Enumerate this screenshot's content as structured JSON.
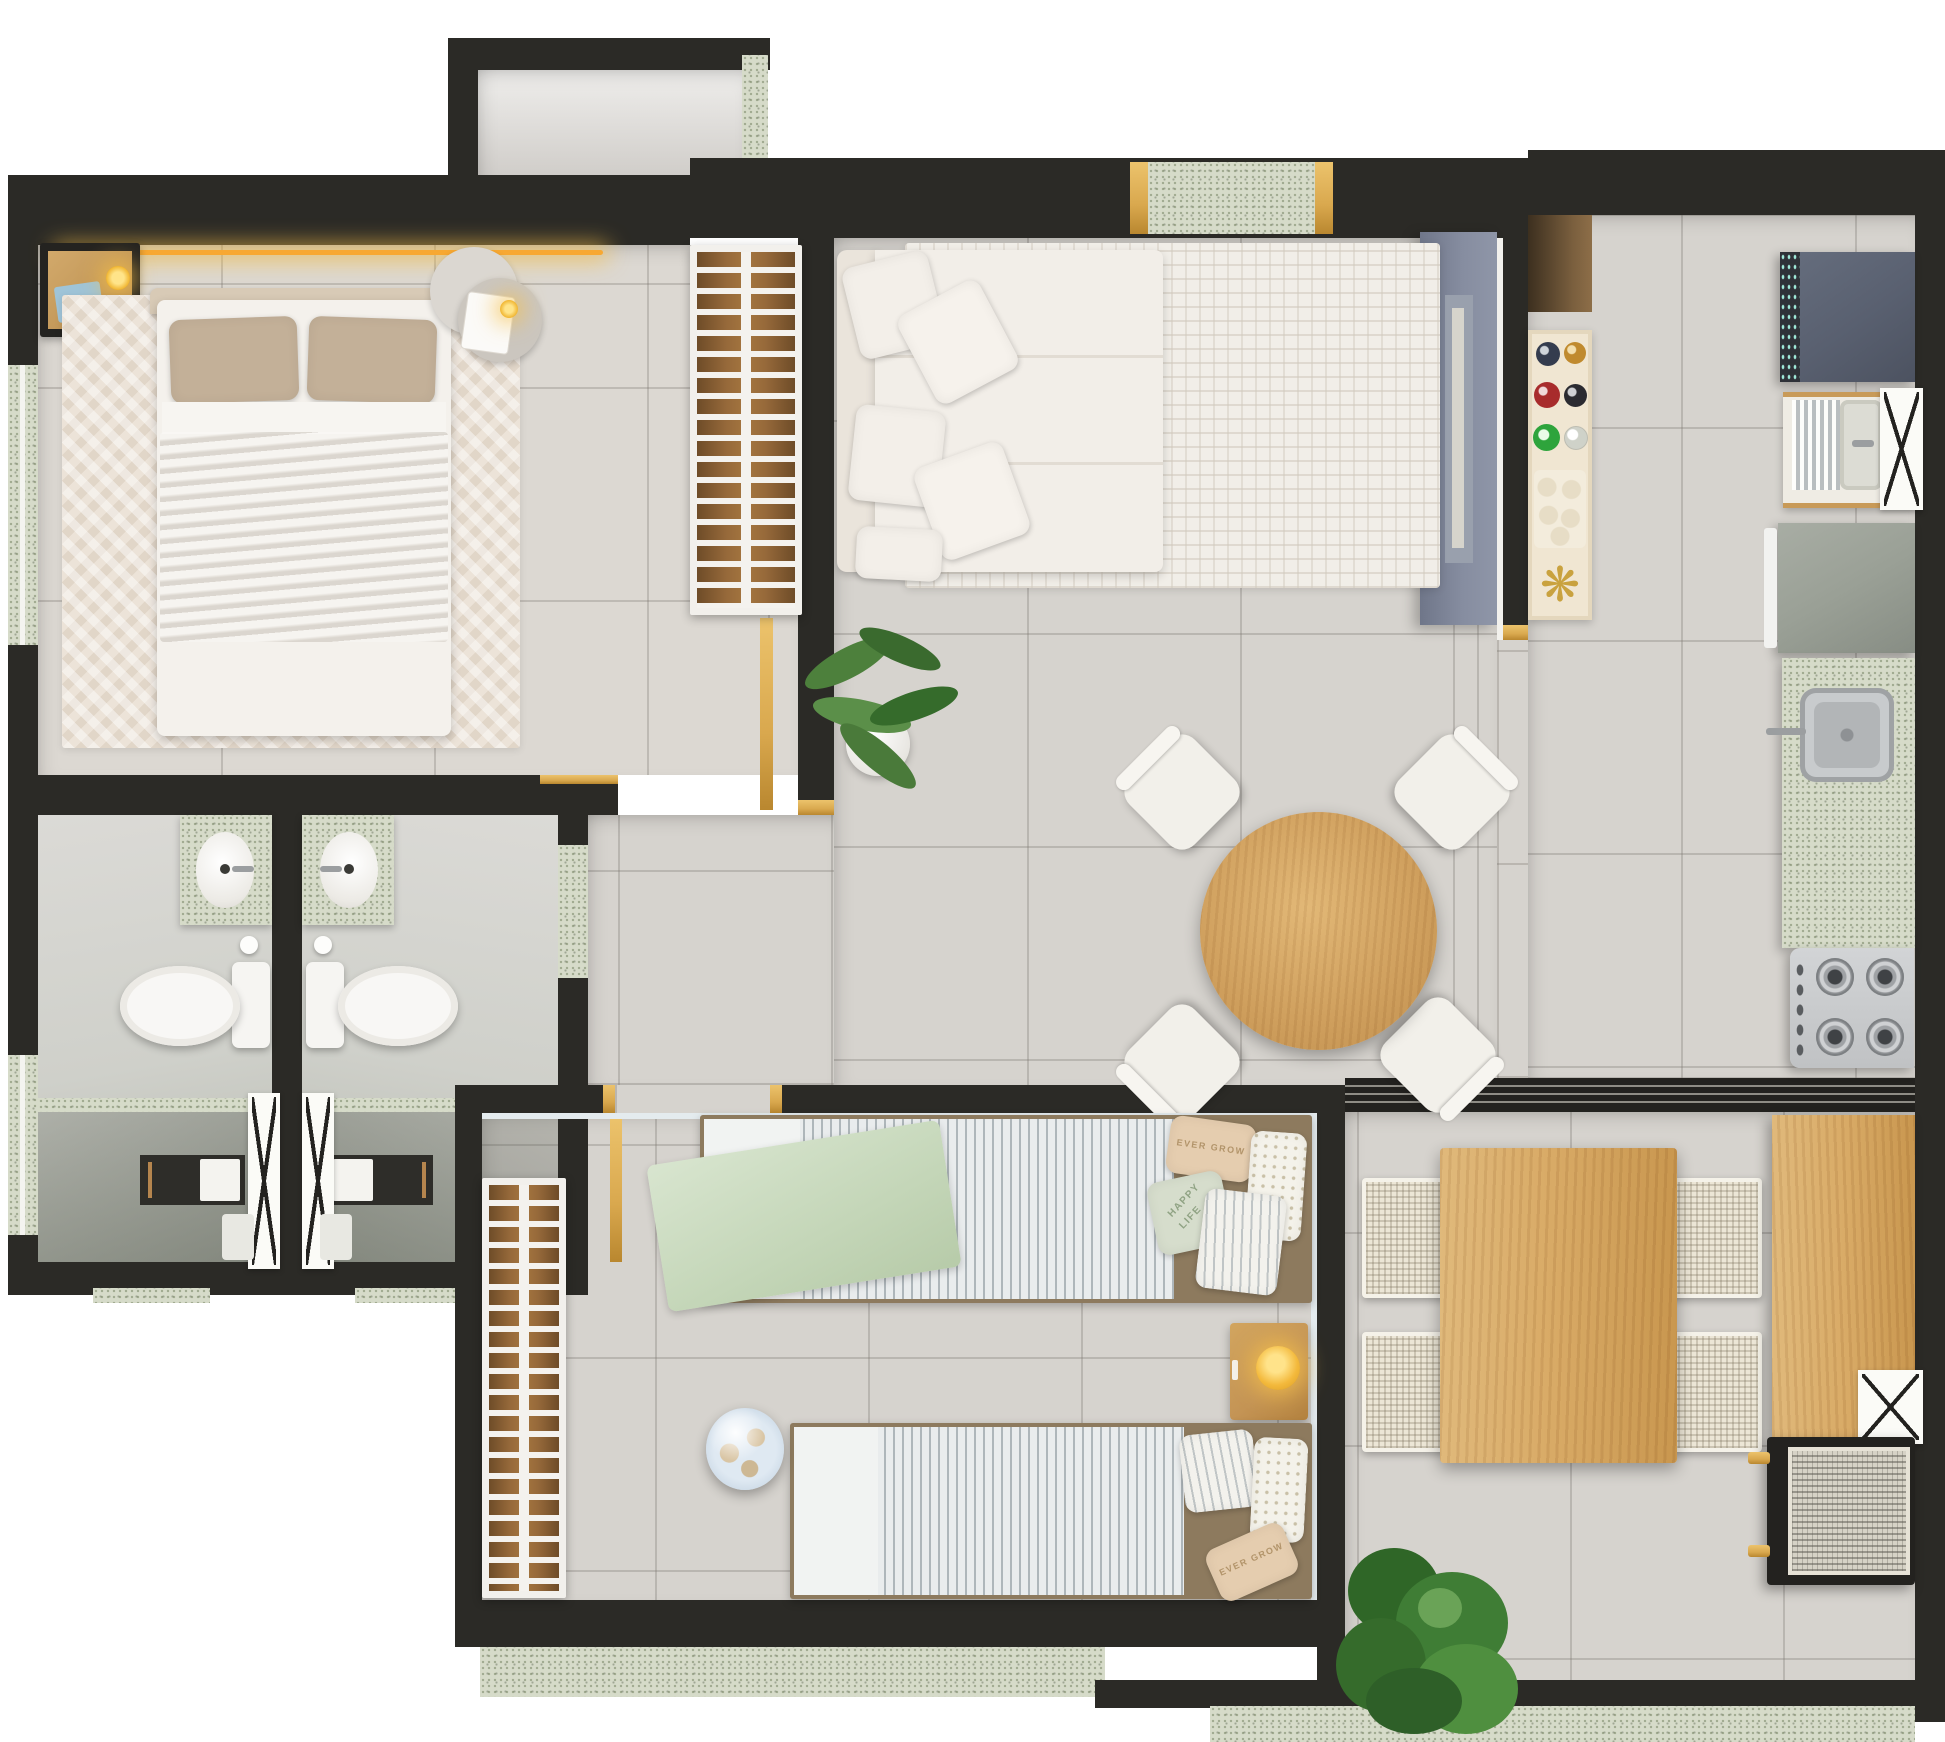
{
  "scene": {
    "kind": "apartment-floor-plan-top-down-render",
    "style": "3d-rendered",
    "rooms_count": 8
  },
  "palette": {
    "wall": "#2b2a26",
    "gold": "#d9a84e",
    "floor": "#d6d3ce",
    "bedroom_floor": "#dcd8d2",
    "rug_bedroom": "#ece3d8",
    "rug_living": "#f1eee8",
    "linen_taupe": "#b9a78f",
    "linen_white": "#f4f1ec",
    "sofa": "#f2eee8",
    "wood": "#cda266",
    "wood_dark": "#8a6134",
    "balcony_wood": "#d9ab67",
    "granite": "#d6dbc9",
    "washer": "#596070",
    "fridge": "#9aa096",
    "tv_console": "#828a9c",
    "steel": "#c6c8ca",
    "lamp": "#f3b93c",
    "led": "#f7a832",
    "plant": "#3f7d35",
    "kids_green": "#ccdcc2",
    "stripe_dark": "#aeb6ba",
    "bath_floor": "#d5d6d1"
  },
  "texts": {
    "pillow_top_bed": "EVER GROW",
    "pillow_happy_line1": "HAPPY",
    "pillow_happy_line2": "LIFE",
    "pillow_bottom_bed": "EVER GROW"
  },
  "icons": {
    "starburst": "❋"
  },
  "inventory": {
    "entry_hall": [
      "entry-threshold"
    ],
    "master_bedroom": [
      "double-bed",
      "nightstand",
      "pendant-lamp",
      "led-strip",
      "side-table",
      "wardrobe",
      "herringbone-rug"
    ],
    "living_dining": [
      "sofa",
      "throw-pillows",
      "area-rug",
      "potted-plant",
      "round-dining-table",
      "dining-chairs",
      "tv-console",
      "bar-cabinet",
      "bottles",
      "glasses",
      "starburst-decor"
    ],
    "kitchen_laundry": [
      "washing-machine",
      "laundry-tank-sink",
      "refrigerator",
      "granite-counter",
      "steel-sink",
      "gas-stove"
    ],
    "bathroom_left": [
      "granite-vanity",
      "sink",
      "toilet",
      "toilet-paper",
      "shower-niche",
      "towel",
      "glass-shower-door",
      "bath-mat"
    ],
    "bathroom_right": [
      "granite-vanity",
      "sink",
      "toilet",
      "toilet-paper",
      "shower-niche",
      "towel",
      "glass-shower-door",
      "bath-mat"
    ],
    "kids_bedroom": [
      "single-bed-top",
      "single-bed-bottom",
      "green-blanket",
      "striped-duvets",
      "nightstand-lamp",
      "wardrobe",
      "globe"
    ],
    "balcony": [
      "wood-dining-table",
      "rattan-chairs",
      "wood-counter",
      "x-stool",
      "barbecue-grill",
      "large-plant"
    ]
  }
}
